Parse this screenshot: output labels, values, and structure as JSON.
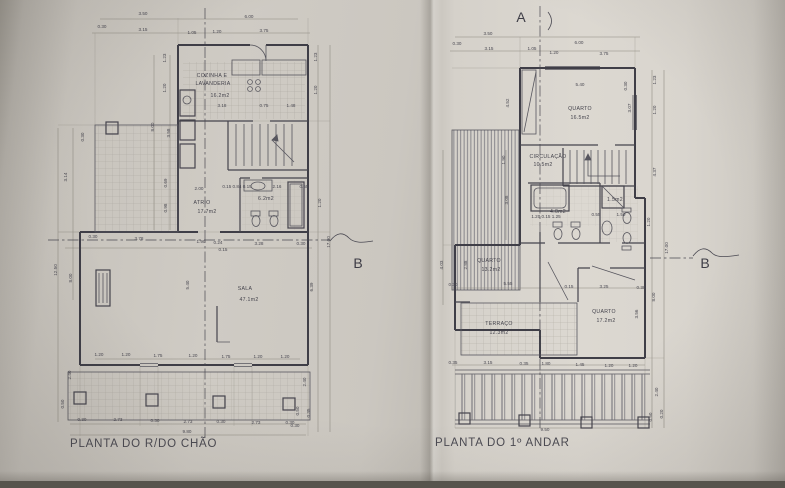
{
  "titles": {
    "left": "PLANTA DO R/DO CHÃO",
    "right": "PLANTA DO 1º ANDAR"
  },
  "colors": {
    "paper": "#d5d1ca",
    "ink": "#3f3e47",
    "dim_ink": "#8b887f"
  },
  "labels": {
    "left": [
      {
        "t": "3.50",
        "x": 143,
        "y": 15
      },
      {
        "t": "6.00",
        "x": 249,
        "y": 18
      },
      {
        "t": "0.30",
        "x": 102,
        "y": 28
      },
      {
        "t": "3.15",
        "x": 143,
        "y": 31
      },
      {
        "t": "1.05",
        "x": 192,
        "y": 34
      },
      {
        "t": "1.20",
        "x": 217,
        "y": 33
      },
      {
        "t": "3.75",
        "x": 264,
        "y": 32
      },
      {
        "t": "1.23",
        "x": 166,
        "y": 58,
        "r": -90
      },
      {
        "t": "1.20",
        "x": 166,
        "y": 88,
        "r": -90
      },
      {
        "t": "1.23",
        "x": 317,
        "y": 57,
        "r": -90
      },
      {
        "t": "1.20",
        "x": 317,
        "y": 90,
        "r": -90
      },
      {
        "t": "8.00",
        "x": 154,
        "y": 127,
        "r": -90
      },
      {
        "t": "3.58",
        "x": 170,
        "y": 133,
        "r": -90
      },
      {
        "t": "0.30",
        "x": 84,
        "y": 137,
        "r": -90
      },
      {
        "t": "3.14",
        "x": 67,
        "y": 177,
        "r": -90
      },
      {
        "t": "12.50",
        "x": 57,
        "y": 270,
        "r": -90
      },
      {
        "t": "8.00",
        "x": 72,
        "y": 278,
        "r": -90
      },
      {
        "t": "0.69",
        "x": 167,
        "y": 183,
        "r": -90
      },
      {
        "t": "0.98",
        "x": 167,
        "y": 208,
        "r": -90
      },
      {
        "t": "COZINHA E",
        "x": 212,
        "y": 77,
        "k": "room"
      },
      {
        "t": "LAVANDERIA",
        "x": 213,
        "y": 85,
        "k": "room"
      },
      {
        "t": "16.2m2",
        "x": 220,
        "y": 97,
        "k": "room"
      },
      {
        "t": "3.18",
        "x": 222,
        "y": 107
      },
      {
        "t": "0.75",
        "x": 264,
        "y": 107
      },
      {
        "t": "1.48",
        "x": 291,
        "y": 107
      },
      {
        "t": "2.00",
        "x": 199,
        "y": 190
      },
      {
        "t": "ATRIO",
        "x": 202,
        "y": 204,
        "k": "room"
      },
      {
        "t": "17.7m2",
        "x": 207,
        "y": 213,
        "k": "room"
      },
      {
        "t": "0.15 0.84 0.15",
        "x": 237,
        "y": 188,
        "s": 3.2
      },
      {
        "t": "2.16",
        "x": 277,
        "y": 188,
        "s": 4
      },
      {
        "t": "0.55",
        "x": 304,
        "y": 188,
        "s": 3.5
      },
      {
        "t": "6.2m2",
        "x": 266,
        "y": 200,
        "k": "room",
        "s": 4.6
      },
      {
        "t": "1.20",
        "x": 321,
        "y": 203,
        "r": -90
      },
      {
        "t": "17.00",
        "x": 330,
        "y": 242,
        "r": -90
      },
      {
        "t": "0.30",
        "x": 93,
        "y": 238
      },
      {
        "t": "3.78",
        "x": 139,
        "y": 240
      },
      {
        "t": "1.90",
        "x": 201,
        "y": 243
      },
      {
        "t": "0.24",
        "x": 218,
        "y": 244,
        "s": 3.5
      },
      {
        "t": "3.28",
        "x": 259,
        "y": 245
      },
      {
        "t": "0.15",
        "x": 223,
        "y": 251,
        "s": 3.2
      },
      {
        "t": "0.30",
        "x": 301,
        "y": 245,
        "s": 4
      },
      {
        "t": "5.40",
        "x": 189,
        "y": 285,
        "r": -90
      },
      {
        "t": "SALA",
        "x": 245,
        "y": 290,
        "k": "room"
      },
      {
        "t": "47.1m2",
        "x": 249,
        "y": 301,
        "k": "room"
      },
      {
        "t": "6.39",
        "x": 313,
        "y": 287,
        "r": -90
      },
      {
        "t": "1.20",
        "x": 99,
        "y": 356
      },
      {
        "t": "1.20",
        "x": 126,
        "y": 356
      },
      {
        "t": "1.75",
        "x": 158,
        "y": 357
      },
      {
        "t": "1.20",
        "x": 193,
        "y": 357
      },
      {
        "t": "1.75",
        "x": 226,
        "y": 358
      },
      {
        "t": "1.20",
        "x": 258,
        "y": 358
      },
      {
        "t": "1.20",
        "x": 285,
        "y": 358
      },
      {
        "t": "2.40",
        "x": 71,
        "y": 375,
        "r": -90
      },
      {
        "t": "0.50",
        "x": 64,
        "y": 404,
        "r": -90
      },
      {
        "t": "0.30",
        "x": 82,
        "y": 421
      },
      {
        "t": "2.73",
        "x": 118,
        "y": 421
      },
      {
        "t": "0.30",
        "x": 155,
        "y": 422
      },
      {
        "t": "2.73",
        "x": 188,
        "y": 423
      },
      {
        "t": "0.30",
        "x": 221,
        "y": 423
      },
      {
        "t": "2.73",
        "x": 256,
        "y": 424
      },
      {
        "t": "0.30",
        "x": 290,
        "y": 424
      },
      {
        "t": "9.80",
        "x": 187,
        "y": 433
      },
      {
        "t": "2.40",
        "x": 306,
        "y": 382,
        "r": -90
      },
      {
        "t": "0.50",
        "x": 299,
        "y": 411,
        "r": -90
      },
      {
        "t": "0.35",
        "x": 310,
        "y": 413,
        "r": -90
      },
      {
        "t": "0.30",
        "x": 295,
        "y": 427
      },
      {
        "t": "B",
        "x": 358,
        "y": 268,
        "k": "marker"
      }
    ],
    "right": [
      {
        "t": "A",
        "x": 521,
        "y": 22,
        "k": "marker"
      },
      {
        "t": "3.50",
        "x": 488,
        "y": 35
      },
      {
        "t": "0.30",
        "x": 457,
        "y": 45
      },
      {
        "t": "3.15",
        "x": 489,
        "y": 50
      },
      {
        "t": "6.00",
        "x": 579,
        "y": 44
      },
      {
        "t": "1.05",
        "x": 532,
        "y": 50
      },
      {
        "t": "1.20",
        "x": 554,
        "y": 54
      },
      {
        "t": "3.75",
        "x": 604,
        "y": 55
      },
      {
        "t": "5.40",
        "x": 580,
        "y": 86
      },
      {
        "t": "0.30",
        "x": 627,
        "y": 86,
        "r": -90,
        "s": 4
      },
      {
        "t": "QUARTO",
        "x": 580,
        "y": 110,
        "k": "room"
      },
      {
        "t": "16.5m2",
        "x": 580,
        "y": 119,
        "k": "room"
      },
      {
        "t": "1.23",
        "x": 656,
        "y": 80,
        "r": -90
      },
      {
        "t": "3.07",
        "x": 631,
        "y": 108,
        "r": -90
      },
      {
        "t": "1.20",
        "x": 656,
        "y": 110,
        "r": -90
      },
      {
        "t": "4.52",
        "x": 509,
        "y": 103,
        "r": -90
      },
      {
        "t": "4.37",
        "x": 656,
        "y": 172,
        "r": -90
      },
      {
        "t": "1.90",
        "x": 505,
        "y": 160,
        "r": -90
      },
      {
        "t": "3.08",
        "x": 508,
        "y": 200,
        "r": -90
      },
      {
        "t": "CIRCULAÇÃO",
        "x": 548,
        "y": 158,
        "k": "room",
        "s": 4.4
      },
      {
        "t": "10.5m2",
        "x": 543,
        "y": 166,
        "k": "room"
      },
      {
        "t": "4.0m2",
        "x": 558,
        "y": 213,
        "k": "room",
        "s": 4.4
      },
      {
        "t": "1.20 0.15 1.25",
        "x": 546,
        "y": 218,
        "s": 3.2
      },
      {
        "t": "0.55",
        "x": 596,
        "y": 216,
        "s": 3.4
      },
      {
        "t": "1.50",
        "x": 621,
        "y": 216,
        "s": 3.4
      },
      {
        "t": "1.5m2",
        "x": 615,
        "y": 201,
        "k": "room",
        "s": 4
      },
      {
        "t": "1.20",
        "x": 650,
        "y": 222,
        "r": -90
      },
      {
        "t": "17.00",
        "x": 668,
        "y": 248,
        "r": -90
      },
      {
        "t": "QUARTO",
        "x": 489,
        "y": 262,
        "k": "room"
      },
      {
        "t": "13.2m2",
        "x": 491,
        "y": 271,
        "k": "room"
      },
      {
        "t": "4.03",
        "x": 443,
        "y": 265,
        "r": -90
      },
      {
        "t": "2.88",
        "x": 467,
        "y": 265,
        "r": -90
      },
      {
        "t": "0.30",
        "x": 453,
        "y": 286,
        "s": 4
      },
      {
        "t": "5.55",
        "x": 508,
        "y": 285
      },
      {
        "t": "0.15",
        "x": 569,
        "y": 288,
        "s": 3.4
      },
      {
        "t": "3.25",
        "x": 604,
        "y": 288
      },
      {
        "t": "0.30",
        "x": 641,
        "y": 289,
        "s": 4
      },
      {
        "t": "8.00",
        "x": 655,
        "y": 297,
        "r": -90
      },
      {
        "t": "3.56",
        "x": 638,
        "y": 314,
        "r": -90
      },
      {
        "t": "TERRAÇO",
        "x": 499,
        "y": 325,
        "k": "room"
      },
      {
        "t": "12.3m2",
        "x": 499,
        "y": 334,
        "k": "room"
      },
      {
        "t": "QUARTO",
        "x": 604,
        "y": 313,
        "k": "room"
      },
      {
        "t": "17.2m2",
        "x": 606,
        "y": 322,
        "k": "room"
      },
      {
        "t": "0.35",
        "x": 453,
        "y": 364,
        "s": 4
      },
      {
        "t": "3.15",
        "x": 488,
        "y": 364
      },
      {
        "t": "0.35",
        "x": 524,
        "y": 365,
        "s": 4
      },
      {
        "t": "1.80",
        "x": 546,
        "y": 365
      },
      {
        "t": "1.45",
        "x": 580,
        "y": 366
      },
      {
        "t": "1.20",
        "x": 609,
        "y": 367
      },
      {
        "t": "1.20",
        "x": 633,
        "y": 367
      },
      {
        "t": "9.50",
        "x": 545,
        "y": 431
      },
      {
        "t": "2.40",
        "x": 658,
        "y": 392,
        "r": -90
      },
      {
        "t": "0.50",
        "x": 652,
        "y": 417,
        "r": -90
      },
      {
        "t": "0.20",
        "x": 663,
        "y": 414,
        "r": -90
      },
      {
        "t": "B",
        "x": 705,
        "y": 268,
        "k": "marker"
      }
    ]
  }
}
